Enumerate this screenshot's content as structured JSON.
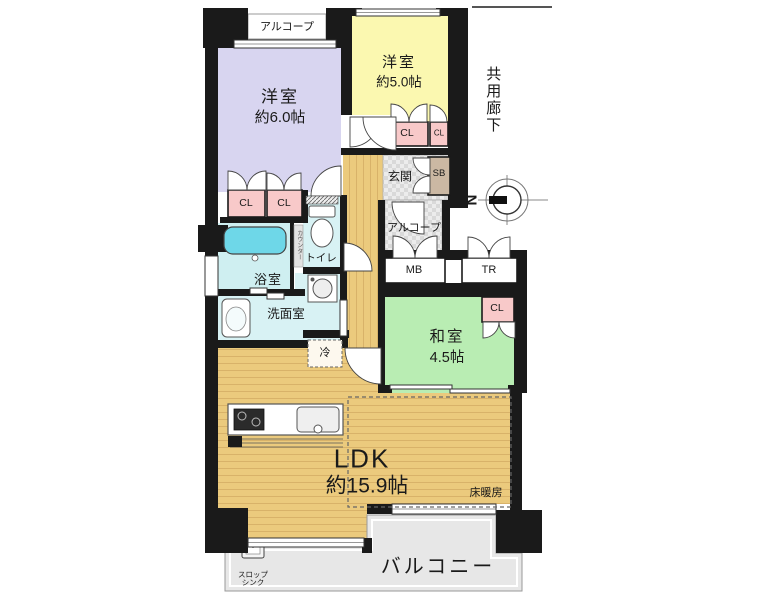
{
  "rooms": {
    "western6": {
      "name": "洋室",
      "size": "約6.0帖"
    },
    "western5": {
      "name": "洋室",
      "size": "約5.0帖"
    },
    "japanese": {
      "name": "和室",
      "size": "4.5帖"
    },
    "ldk": {
      "name": "LDK",
      "size": "約15.9帖"
    },
    "bath": "浴室",
    "toilet": "トイレ",
    "washroom": "洗面室",
    "entry": "玄関",
    "alcove_top": "アルコープ",
    "alcove_entry": "アルコープ",
    "balcony": "バルコニー",
    "corridor": "共用廊下"
  },
  "labels": {
    "closet": "CL",
    "shoebox": "SB",
    "meter_box": "MB",
    "trunk": "TR",
    "fridge": "冷",
    "floor_heating": "床暖房",
    "counter": "カウンター",
    "slop_sink": "スロップ\nシンク",
    "north": "N"
  },
  "colors": {
    "wall": "#1a1a1a",
    "western6": "#d8d5f0",
    "western5": "#fbf8b0",
    "japanese": "#b9edb3",
    "wood": "#ebca7d",
    "wood_stripe": "#d8b269",
    "closet": "#f8c9c9",
    "shoebox": "#cbb8a3",
    "bath_floor": "#cfeff1",
    "wet_floor": "#d8f2f4",
    "tub": "#6ed7e8",
    "balcony": "#e7e7e7",
    "entry_floor": "#ececec"
  }
}
